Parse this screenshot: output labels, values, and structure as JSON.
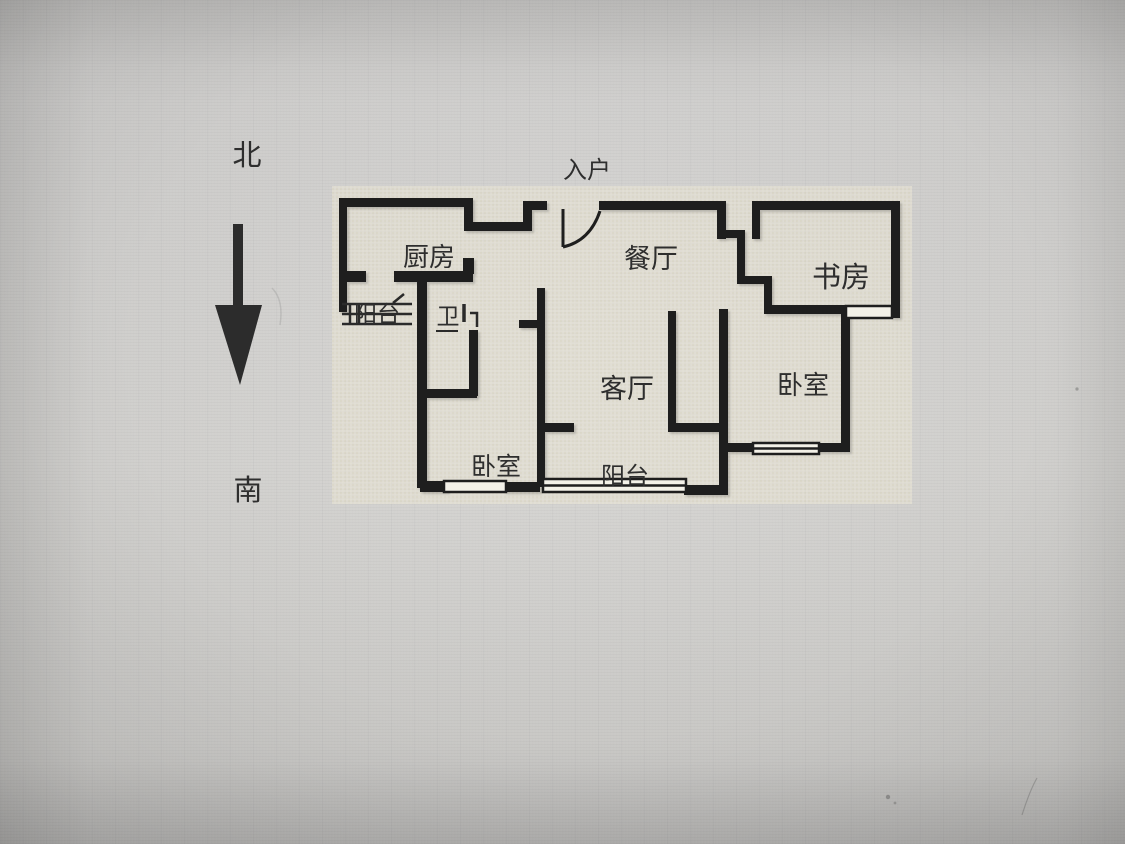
{
  "compass": {
    "north": "北",
    "south": "南"
  },
  "rooms": {
    "entrance": "入户",
    "kitchen": "厨房",
    "dining_room": "餐厅",
    "study": "书房",
    "balcony_west": "阳台",
    "bathroom": "卫",
    "living_room": "客厅",
    "bedroom_east": "卧室",
    "bedroom_south": "卧室",
    "balcony_south": "阳台"
  },
  "colors": {
    "wall": "#1e1e1e",
    "label_text": "#2e2e2e",
    "photo_background": "#d2d1cf",
    "plan_background": "#e8e4d4"
  }
}
